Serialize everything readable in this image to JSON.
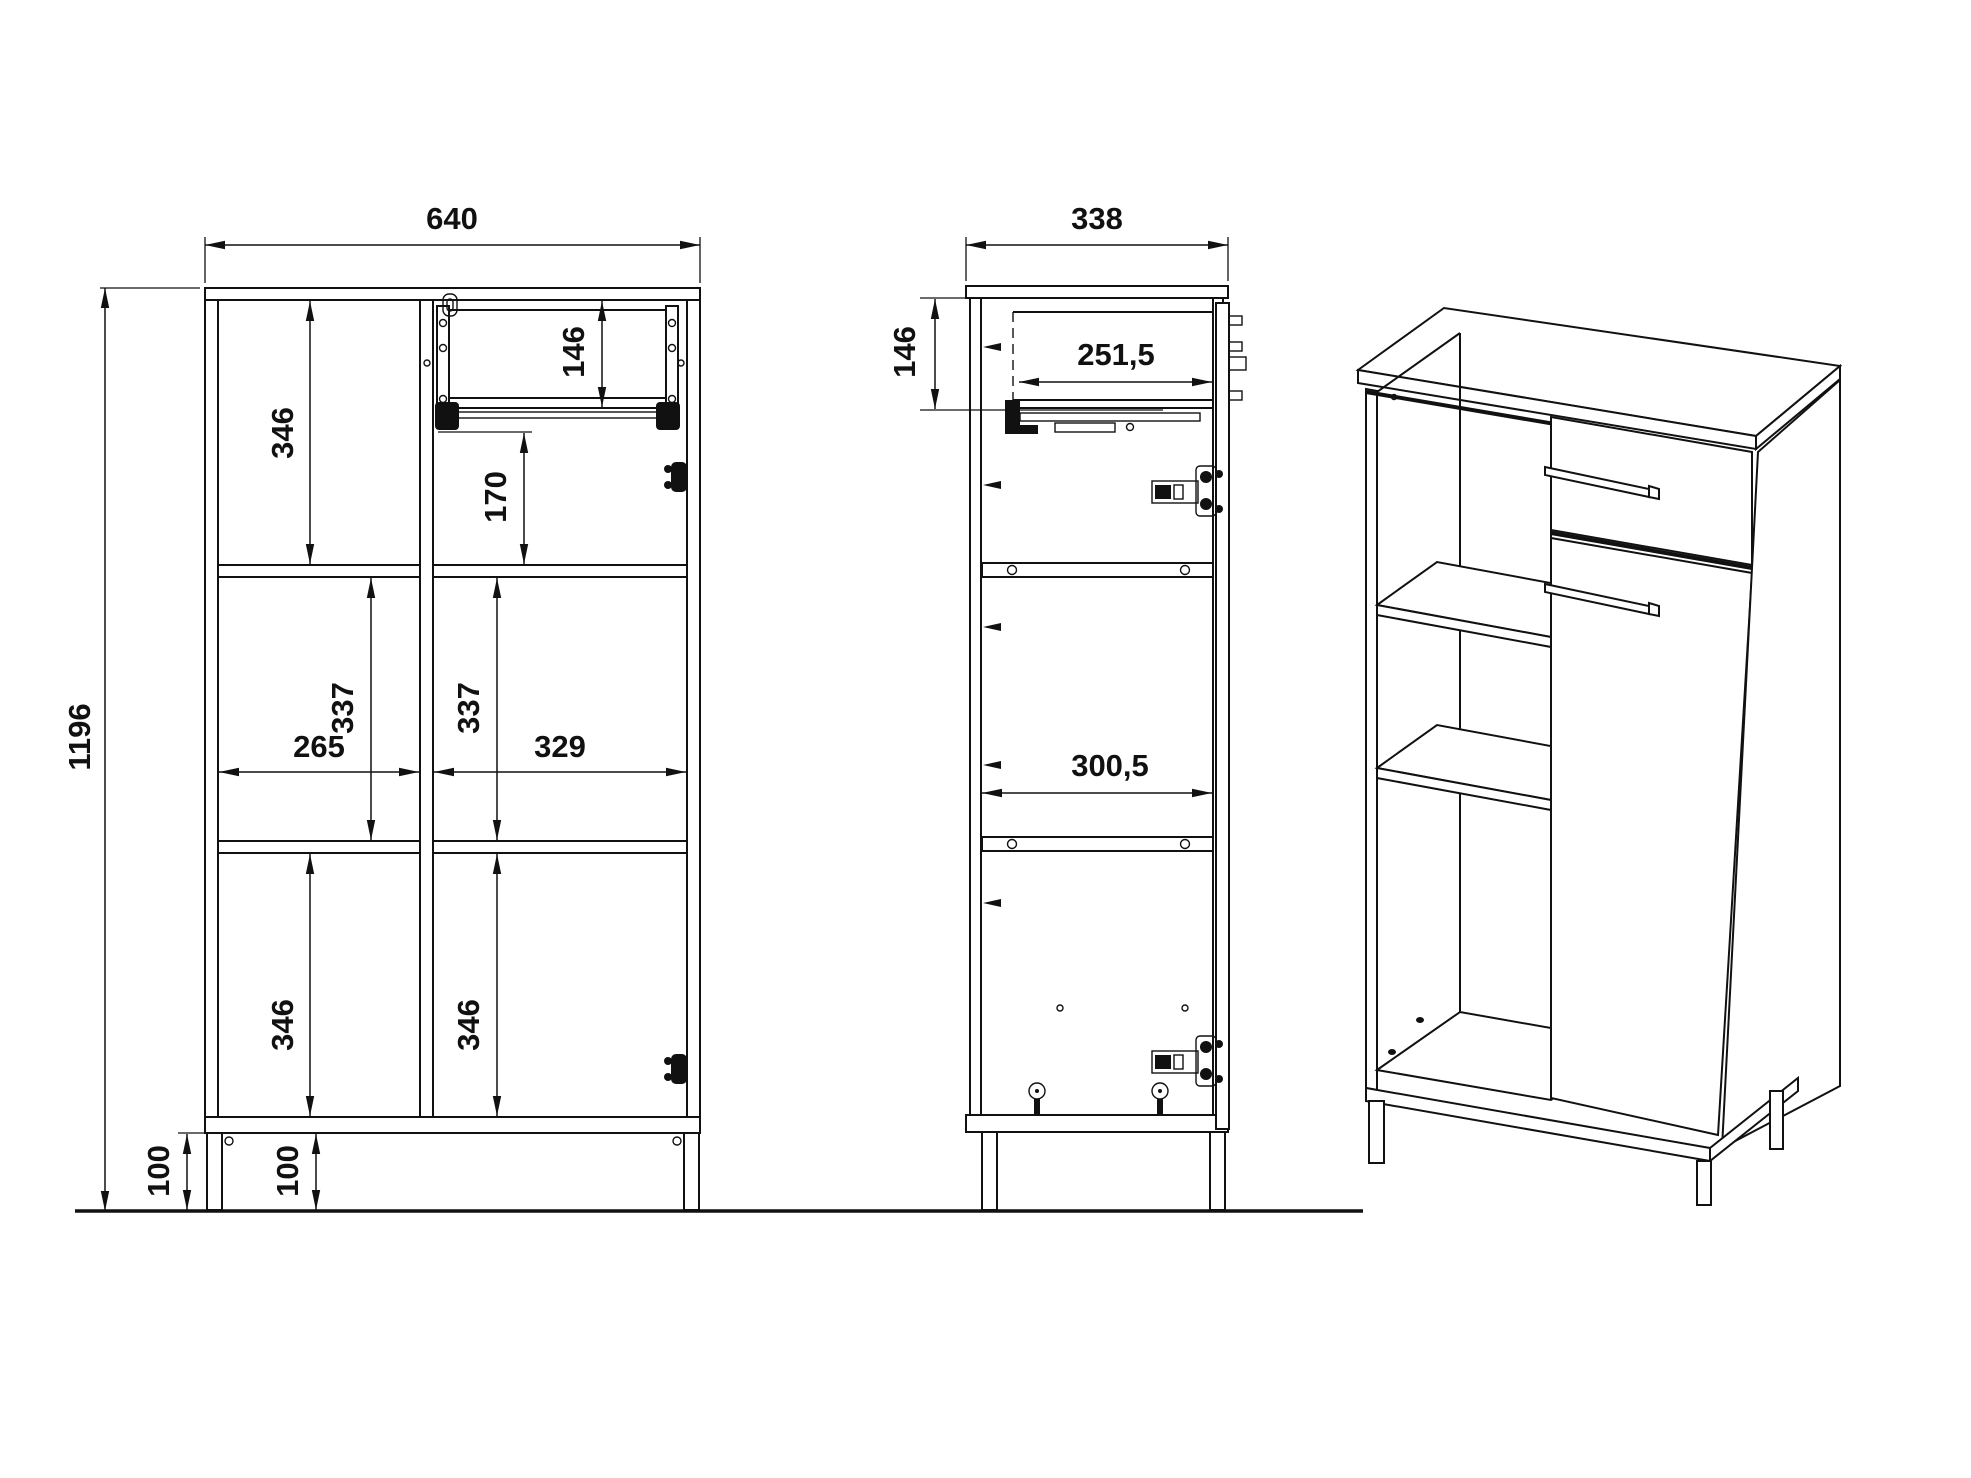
{
  "drawing": {
    "background": "#ffffff",
    "line_color": "#111111"
  },
  "dims": {
    "front_width": "640",
    "front_height": "1196",
    "front_cell_top_left_h": "346",
    "front_drawer_h": "146",
    "front_drawer_to_shelf": "170",
    "front_mid_left_h": "337",
    "front_mid_right_h": "337",
    "front_cell_left_w": "265",
    "front_cell_right_w": "329",
    "front_bottom_left_h": "346",
    "front_bottom_right_h": "346",
    "front_leg_h_outer": "100",
    "front_leg_h_inner": "100",
    "side_depth": "338",
    "side_drawer_h": "146",
    "side_drawer_depth": "251,5",
    "side_interior_depth": "300,5"
  }
}
